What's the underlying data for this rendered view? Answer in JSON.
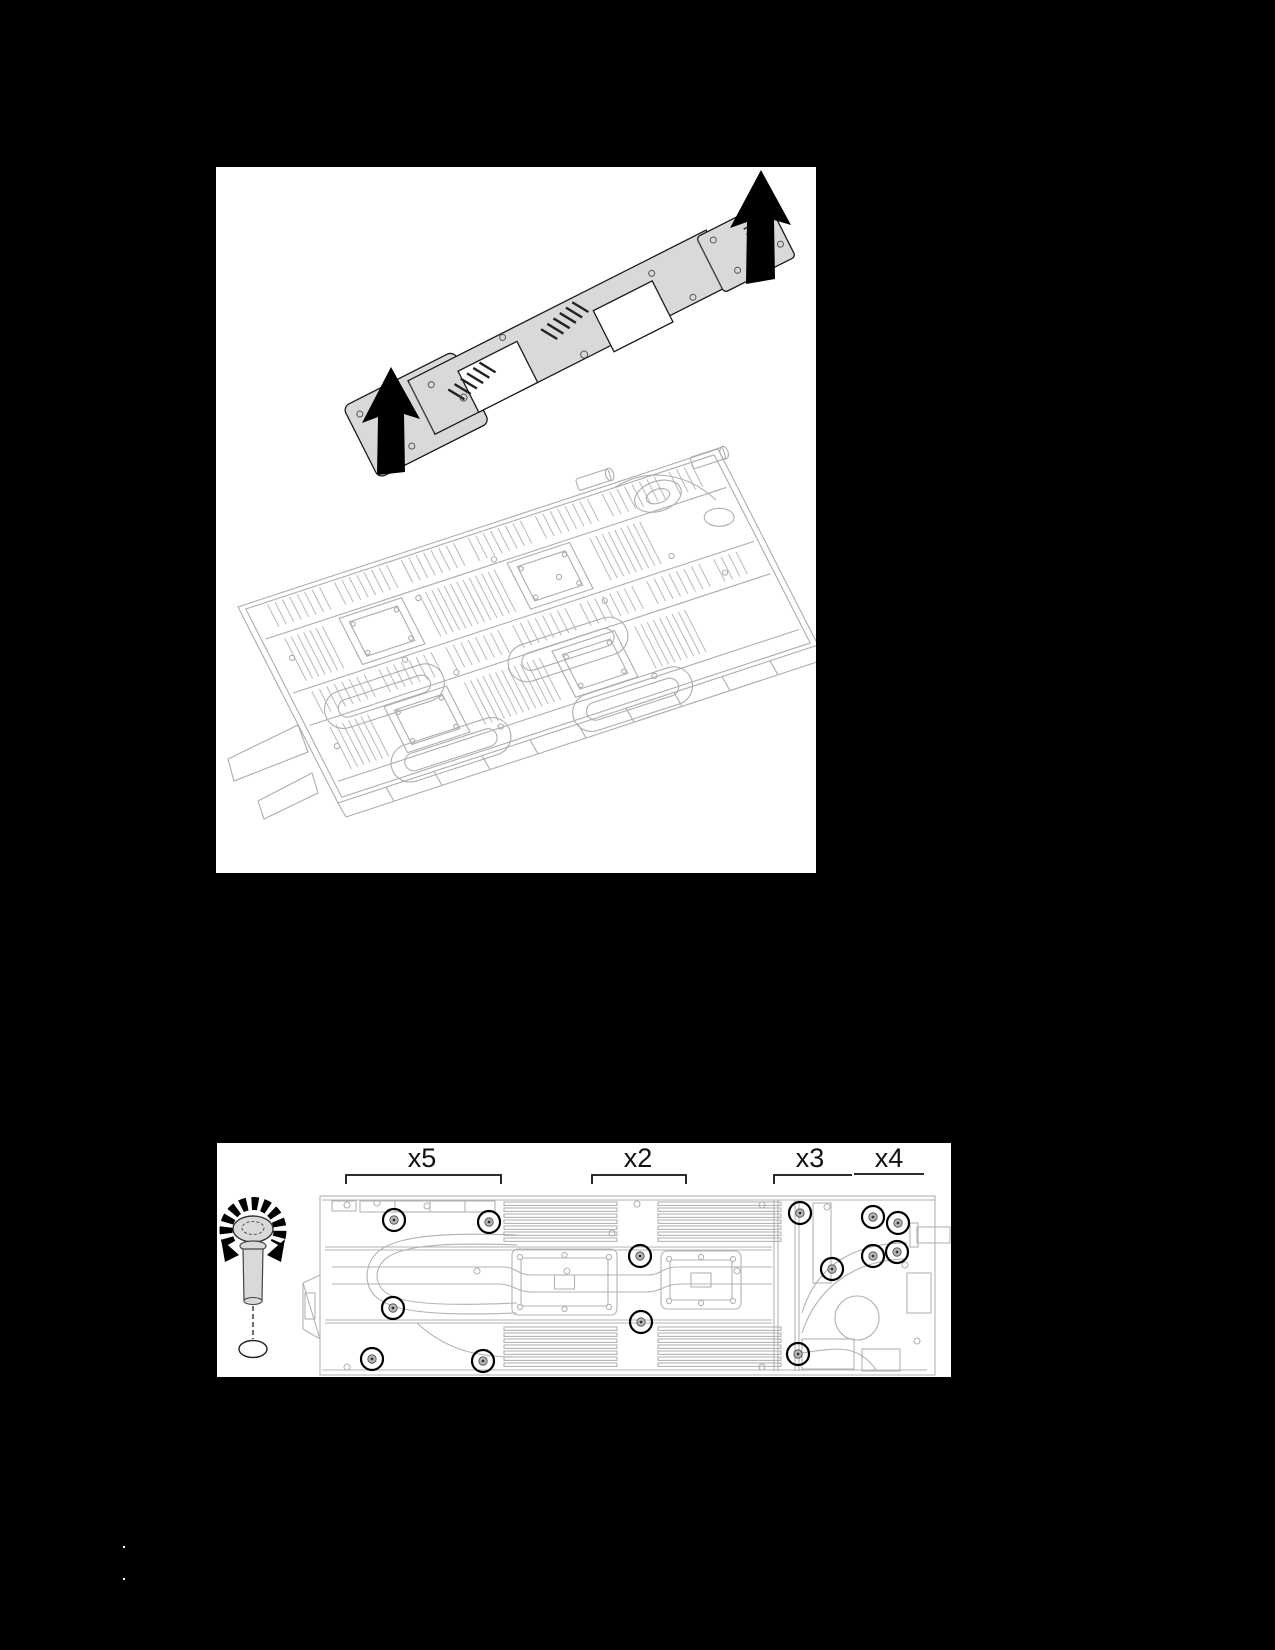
{
  "page": {
    "width_px": 1275,
    "height_px": 1650,
    "background_color": "#000000"
  },
  "figure_carrier_lift": {
    "figure_role": "carrier-lift-off-water-loop-illustration",
    "icons": [
      "lift-arrow-icon",
      "lift-arrow-icon"
    ],
    "drawn_parts": [
      "carrier-plate",
      "water-loop-assembly"
    ]
  },
  "figure_screw_removal": {
    "figure_role": "water-loop-screw-locations-illustration",
    "tool_icon": "torque-screwdriver-icon",
    "total_screws": 14,
    "screw_groups": [
      {
        "label": "x5",
        "count": 5,
        "label_x": 205,
        "bracket": {
          "x1": 129,
          "x2": 284,
          "y": 32,
          "ticks": "both"
        },
        "screws": [
          [
            177,
            77
          ],
          [
            272,
            79
          ],
          [
            176,
            165
          ],
          [
            155,
            216
          ],
          [
            266,
            218
          ]
        ]
      },
      {
        "label": "x2",
        "count": 2,
        "label_x": 421,
        "bracket": {
          "x1": 375,
          "x2": 469,
          "y": 32,
          "ticks": "both"
        },
        "screws": [
          [
            423,
            113
          ],
          [
            424,
            179
          ]
        ]
      },
      {
        "label": "x3",
        "count": 3,
        "label_x": 593,
        "bracket": {
          "x1": 557,
          "x2": 635,
          "y": 32,
          "ticks": "left"
        },
        "screws": [
          [
            583,
            70
          ],
          [
            615,
            126
          ],
          [
            581,
            211
          ]
        ]
      },
      {
        "label": "x4",
        "count": 4,
        "label_x": 672,
        "bracket": {
          "x1": 637,
          "x2": 707,
          "y": 31,
          "ticks": "none"
        },
        "screws": [
          [
            656,
            74
          ],
          [
            681,
            80
          ],
          [
            656,
            113
          ],
          [
            680,
            109
          ]
        ]
      }
    ]
  },
  "stray_dots": [
    [
      123,
      1546
    ],
    [
      123,
      1578
    ]
  ],
  "colors": {
    "page_background": "#000000",
    "figure_background": "#ffffff",
    "line_art": "#adadad",
    "outline": "#1a1a1a",
    "plate_fill": "#d9d9d9",
    "arrow_fill": "#000000",
    "label_text": "#111111"
  }
}
